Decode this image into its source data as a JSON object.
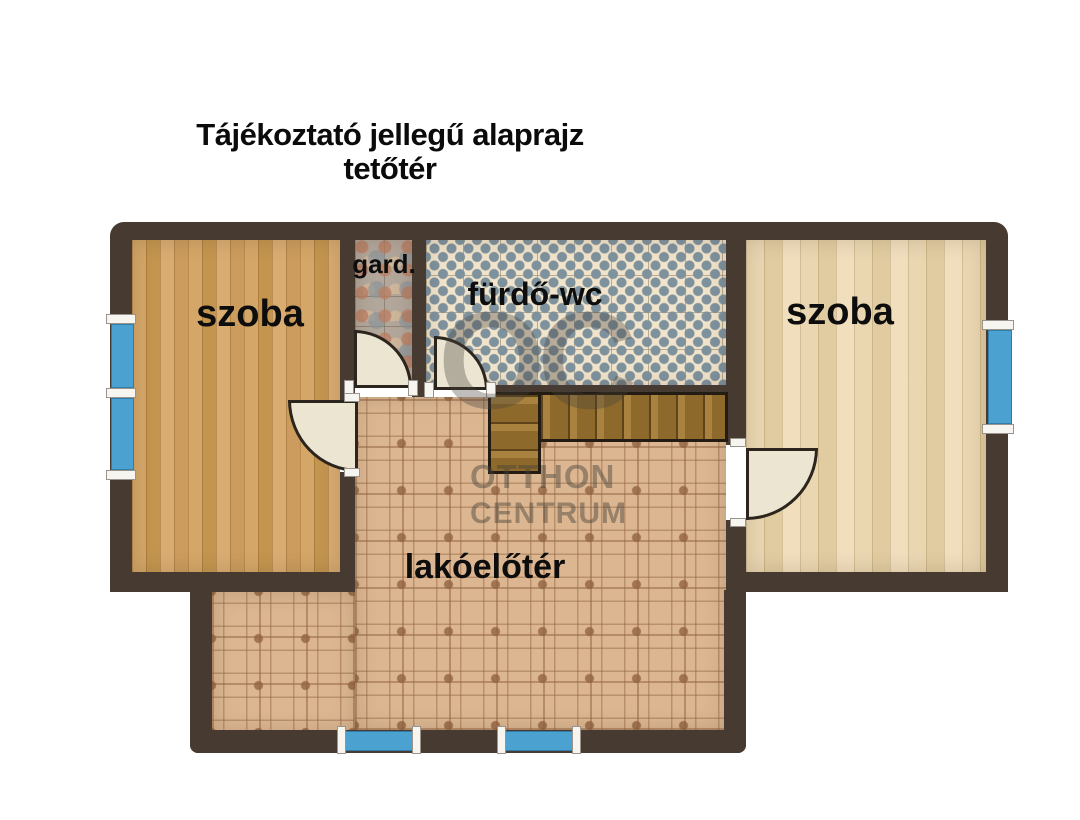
{
  "title": {
    "line1": "Tájékoztató jellegű alaprajz",
    "line2": "tetőtér"
  },
  "rooms": {
    "szoba_left": {
      "label": "szoba",
      "floor": "oak-plank-wood"
    },
    "gard": {
      "label": "gard.",
      "floor": "mottled-stone-tile"
    },
    "furdo": {
      "label": "fürdő-wc",
      "floor": "blue-diamond-mosaic-tile"
    },
    "szoba_right": {
      "label": "szoba",
      "floor": "pale-plank-wood"
    },
    "lakoeloter": {
      "label": "lakóelőtér",
      "floor": "ornamental-terracotta-tile"
    }
  },
  "watermark": {
    "monogram": "OC",
    "line1": "OTTHON",
    "line2": "CENTRUM"
  },
  "colors": {
    "wall": "#473A30",
    "window_glass": "#4BA2D0",
    "door_leaf": "#ECE5D2",
    "oak_floor": "#CFA063",
    "pale_floor": "#E8D5AF",
    "hall_tile": "#DBB691",
    "bath_tile_bg": "#F1E4CB",
    "bath_tile_diamond": "#7E929E",
    "gard_tile": "#B3A79B",
    "stair_wood": "#A8823E",
    "title_text": "#0B0B0B"
  }
}
